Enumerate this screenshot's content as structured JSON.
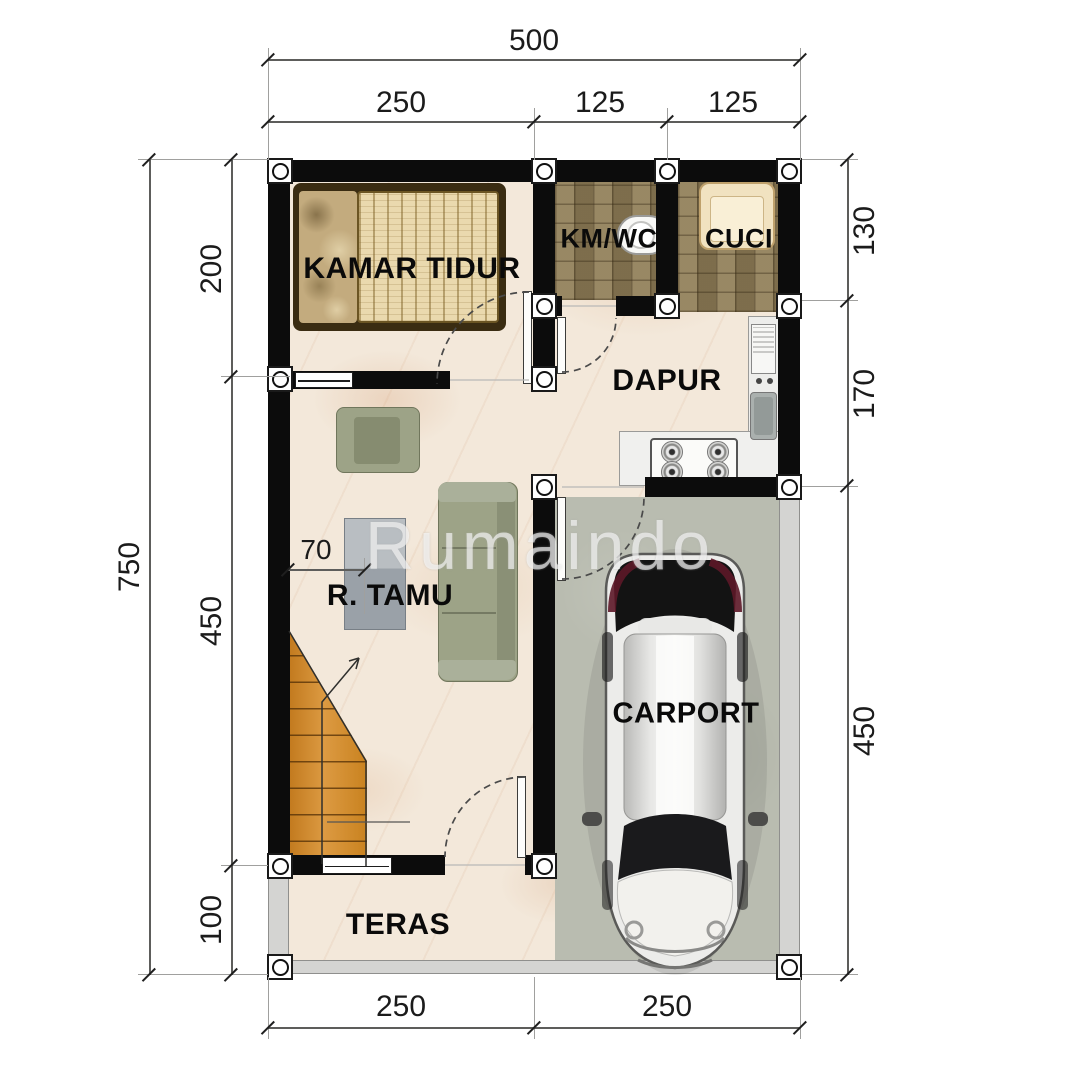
{
  "watermark": "Rumaindo",
  "rooms": {
    "bedroom": "KAMAR TIDUR",
    "bathroom": "KM/WC",
    "laundry": "CUCI",
    "kitchen": "DAPUR",
    "living_room": "R. TAMU",
    "carport": "CARPORT",
    "terrace": "TERAS"
  },
  "dimensions": {
    "top_total": "500",
    "top_segments": [
      "250",
      "125",
      "125"
    ],
    "left_total": "750",
    "left_segments": [
      "200",
      "450",
      "100"
    ],
    "right_segments": [
      "130",
      "170",
      "450"
    ],
    "bottom_segments": [
      "250",
      "250"
    ],
    "living_clearance": "70"
  },
  "colors": {
    "wall": "#0c0c0c",
    "marble_floor": "#f3e8da",
    "tile_floor": "#8d7c58",
    "carport_floor": "#b9bcb0",
    "stair_wood": "#d6902f",
    "sofa_fabric": "#9da387",
    "dimension_text": "#1b1b1b"
  }
}
